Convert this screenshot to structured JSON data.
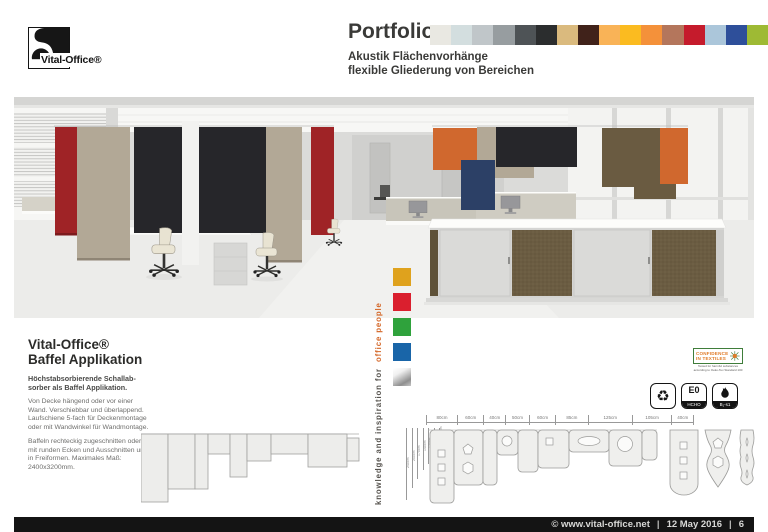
{
  "brand": {
    "logo_label": "Vital-Office®"
  },
  "header": {
    "title": "Portfolio",
    "subtitle1": "Akustik Flächenvorhänge",
    "subtitle2": "flexible Gliederung von Bereichen",
    "swatches": [
      "#e9e8e2",
      "#d3dedf",
      "#c0c6c9",
      "#979da0",
      "#4e5356",
      "#2b2d2e",
      "#daba7e",
      "#40221a",
      "#f9b357",
      "#fbbb20",
      "#f4913a",
      "#b4765c",
      "#c51b2c",
      "#abc6da",
      "#2e4f9a",
      "#9eba34"
    ]
  },
  "scene": {
    "panel_red": "#9f2326",
    "panel_beige": "#b2a896",
    "panel_black": "#26262a",
    "panel_orange": "#d0682e",
    "panel_navy": "#2c4066",
    "panel_brown": "#6a5b41",
    "cabinet_brown": "#6b5c42",
    "wall": "#dbdbd9",
    "floor": "#ececea"
  },
  "tagline": {
    "prefix": "knowledge and inspiration for",
    "highlight": "office people",
    "squares": [
      {
        "name": "gold",
        "color": "#dfa21d"
      },
      {
        "name": "red",
        "color": "#da1f2e"
      },
      {
        "name": "green",
        "color": "#2fa23c"
      },
      {
        "name": "blue",
        "color": "#1965a8"
      },
      {
        "name": "silver",
        "color": "linear-gradient(150deg,#ffffff 0%,#f0f0f0 30%,#8f8f8f 75%,#c6c6c6 100%)"
      }
    ]
  },
  "info": {
    "brand": "Vital-Office®",
    "product": "Baffel Applikation",
    "lead": "Höchstabsorbierende Schallab­sorber als Baffel Applikation.",
    "body1": "Von Decke hängend oder vor einer Wand. Verschiebbar und überlappend. Laufschiene 5-fach für Deckenmontage oder mit Wandwinkel für Wandmontage.",
    "body2": "Baffeln rechteckig zugeschnitten oder mit runden Ecken und Ausschnitten und in Freiformen. Maximales Maß: 2400x3200mm."
  },
  "diagram": {
    "width_labels": [
      "80cm",
      "60cm",
      "40cm",
      "50cm",
      "60cm",
      "85cm",
      "125cm",
      "105cm",
      "40cm"
    ],
    "height_labels": [
      "240cm",
      "200cm",
      "170cm",
      "140cm",
      "120cm",
      "80cm",
      "40cm"
    ]
  },
  "certs": {
    "oeko_line1": "CONFIDENCE",
    "oeko_line2": "IN TEXTILES",
    "oeko_note": "Tested for harmful substances according to Oeko-Tex Standard 100",
    "badge_e0": "E0",
    "badge_hcho": "HCHO",
    "badge_fire": "B₁-s1"
  },
  "footer": {
    "site": "© www.vital-office.net",
    "date": "12 May 2016",
    "sep": "|",
    "page": "6"
  }
}
